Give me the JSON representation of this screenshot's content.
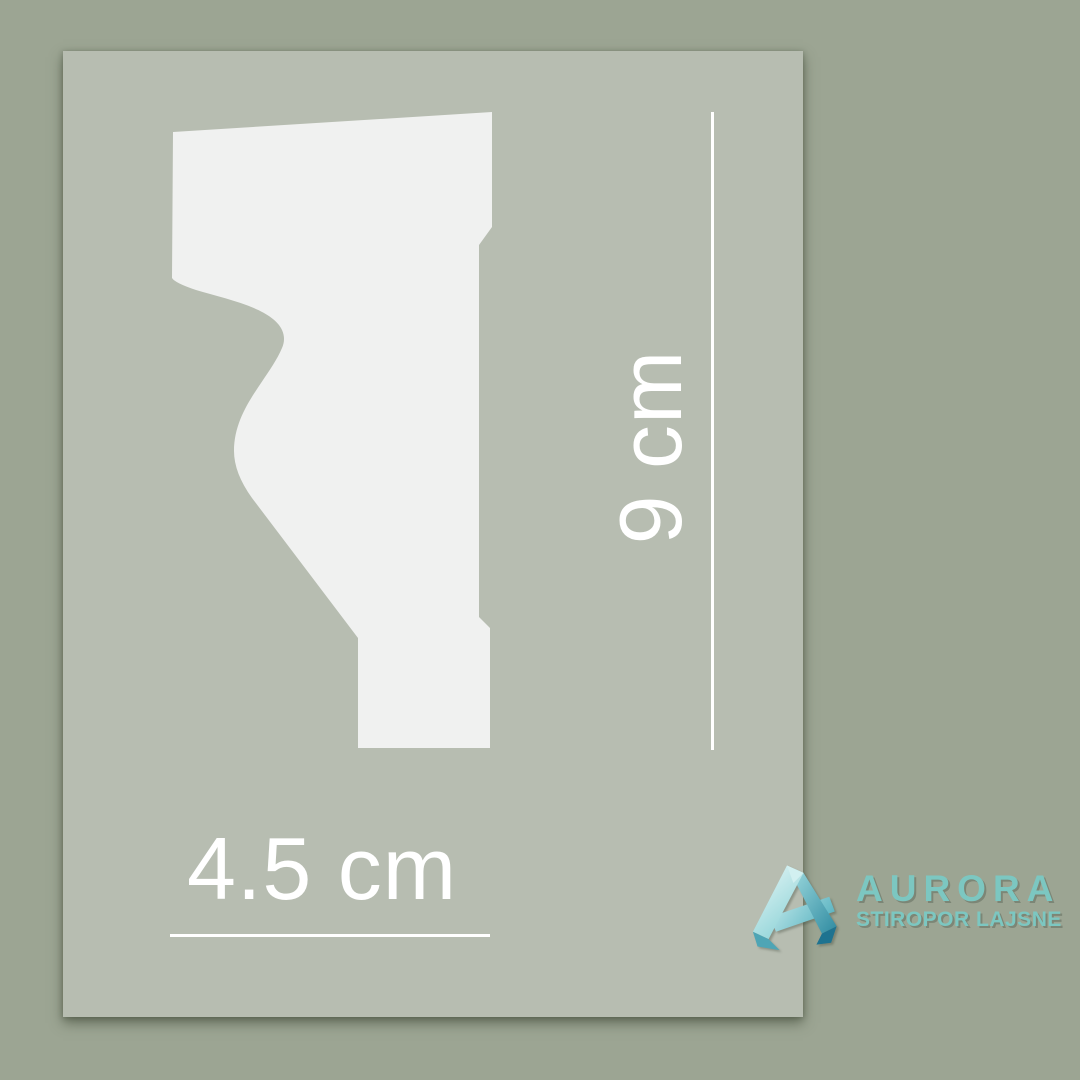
{
  "image": {
    "type": "product-dimension-diagram",
    "subject": "styrofoam-molding-cross-section-profile",
    "background_color": "#9ca593",
    "panel_color": "#b7bdb1",
    "profile_fill_color": "#f0f1f0",
    "dimension_color": "#ffffff"
  },
  "dimensions": {
    "height_label": "9 cm",
    "width_label": "4.5 cm"
  },
  "brand": {
    "name": "AURORA",
    "tagline": "STIROPOR LAJSNE",
    "accent_color": "#7cc7c1",
    "icon": "folded-ribbon-letter-a-icon"
  }
}
